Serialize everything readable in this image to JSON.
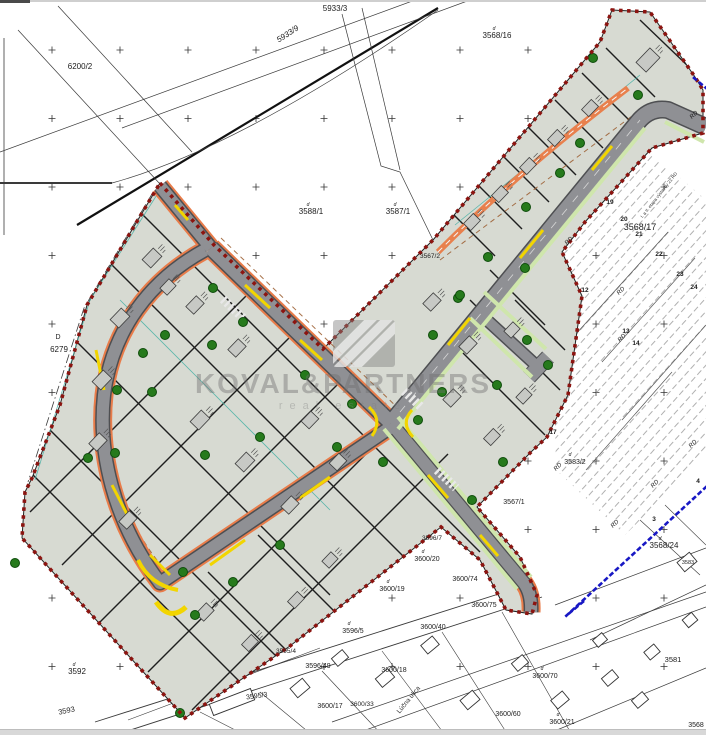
{
  "watermark": {
    "company": "KOVAL&PARTNERS",
    "tagline": "real estate"
  },
  "map": {
    "colors": {
      "dev_fill": "#d7dad2",
      "road": "#8f9094",
      "road_edge": "#e87c4a",
      "verge": "#cfe6ac",
      "tree": "#267a1c",
      "red_boundary": "#8c1410",
      "blue_boundary": "#1818c4",
      "yellow": "#f2d500"
    },
    "parcel_labels": [
      {
        "text": "5933/3",
        "x": 335,
        "y": 11,
        "size": 8
      },
      {
        "text": "5933/9",
        "x": 289,
        "y": 36,
        "rot": -33,
        "size": 8,
        "cls": "it"
      },
      {
        "text": "6200/2",
        "x": 80,
        "y": 69,
        "size": 8
      },
      {
        "text": "3568/16",
        "x": 497,
        "y": 38,
        "size": 8
      },
      {
        "text": "3588/1",
        "x": 311,
        "y": 214,
        "size": 8
      },
      {
        "text": "3587/1",
        "x": 398,
        "y": 214,
        "size": 8
      },
      {
        "text": "D",
        "x": 58,
        "y": 339,
        "size": 7
      },
      {
        "text": "6279",
        "x": 59,
        "y": 352,
        "size": 8
      },
      {
        "text": "3568/17",
        "x": 640,
        "y": 230,
        "size": 9
      },
      {
        "text": "3567/2",
        "x": 430,
        "y": 258,
        "size": 6.5
      },
      {
        "text": "3567/1",
        "x": 514,
        "y": 504,
        "size": 7
      },
      {
        "text": "3583/2",
        "x": 575,
        "y": 464,
        "size": 7
      },
      {
        "text": "3568/24",
        "x": 664,
        "y": 548,
        "size": 8
      },
      {
        "text": "3583",
        "x": 688,
        "y": 564,
        "size": 5.5
      },
      {
        "text": "3581",
        "x": 673,
        "y": 662,
        "size": 7.5
      },
      {
        "text": "3592",
        "x": 77,
        "y": 674,
        "size": 8
      },
      {
        "text": "3593",
        "x": 67,
        "y": 713,
        "rot": -12,
        "size": 7.5
      },
      {
        "text": "3595/3",
        "x": 257,
        "y": 698,
        "rot": -8,
        "size": 7
      },
      {
        "text": "3595/4",
        "x": 286,
        "y": 653,
        "size": 6.5
      },
      {
        "text": "3596/5",
        "x": 353,
        "y": 633,
        "size": 7
      },
      {
        "text": "3596/49",
        "x": 318,
        "y": 668,
        "size": 7
      },
      {
        "text": "3596/7",
        "x": 432,
        "y": 540,
        "size": 6.5
      },
      {
        "text": "3600/20",
        "x": 427,
        "y": 561,
        "size": 7
      },
      {
        "text": "3600/74",
        "x": 465,
        "y": 581,
        "size": 7
      },
      {
        "text": "3600/75",
        "x": 484,
        "y": 607,
        "size": 7
      },
      {
        "text": "3600/19",
        "x": 392,
        "y": 591,
        "size": 7
      },
      {
        "text": "3600/40",
        "x": 433,
        "y": 629,
        "size": 7
      },
      {
        "text": "3600/18",
        "x": 394,
        "y": 672,
        "size": 7
      },
      {
        "text": "3600/17",
        "x": 330,
        "y": 708,
        "size": 7
      },
      {
        "text": "3600/33",
        "x": 362,
        "y": 706,
        "size": 6.5
      },
      {
        "text": "3600/21",
        "x": 562,
        "y": 724,
        "size": 7
      },
      {
        "text": "3600/70",
        "x": 545,
        "y": 678,
        "size": 7
      },
      {
        "text": "3600/60",
        "x": 508,
        "y": 716,
        "size": 7
      },
      {
        "text": "3568",
        "x": 696,
        "y": 727,
        "size": 7
      }
    ],
    "d_marks": [
      {
        "text": "d",
        "x": 308,
        "y": 206
      },
      {
        "text": "d",
        "x": 395,
        "y": 206
      },
      {
        "text": "d",
        "x": 74,
        "y": 666
      },
      {
        "text": "d",
        "x": 423,
        "y": 553
      },
      {
        "text": "d",
        "x": 388,
        "y": 583
      },
      {
        "text": "d",
        "x": 570,
        "y": 456
      },
      {
        "text": "d",
        "x": 660,
        "y": 540
      },
      {
        "text": "d",
        "x": 494,
        "y": 30
      },
      {
        "text": "d",
        "x": 349,
        "y": 625
      },
      {
        "text": "d",
        "x": 558,
        "y": 716
      },
      {
        "text": "d",
        "x": 542,
        "y": 670
      }
    ],
    "lot_numbers": [
      {
        "text": "19",
        "x": 610,
        "y": 204
      },
      {
        "text": "20",
        "x": 624,
        "y": 221
      },
      {
        "text": "21",
        "x": 639,
        "y": 236
      },
      {
        "text": "22",
        "x": 659,
        "y": 256
      },
      {
        "text": "23",
        "x": 680,
        "y": 276
      },
      {
        "text": "24",
        "x": 694,
        "y": 289
      },
      {
        "text": "12",
        "x": 585,
        "y": 292
      },
      {
        "text": "13",
        "x": 626,
        "y": 333
      },
      {
        "text": "14",
        "x": 636,
        "y": 345
      },
      {
        "text": "17",
        "x": 553,
        "y": 434
      },
      {
        "text": "3",
        "x": 654,
        "y": 521
      },
      {
        "text": "4",
        "x": 698,
        "y": 483
      }
    ],
    "zone_labels": [
      {
        "text": "RD",
        "x": 570,
        "y": 242
      },
      {
        "text": "RD",
        "x": 622,
        "y": 292
      },
      {
        "text": "RD",
        "x": 623,
        "y": 339
      },
      {
        "text": "RD",
        "x": 559,
        "y": 468
      },
      {
        "text": "RD",
        "x": 656,
        "y": 485
      },
      {
        "text": "RD",
        "x": 694,
        "y": 445
      },
      {
        "text": "RD",
        "x": 616,
        "y": 525
      },
      {
        "text": "RD",
        "x": 695,
        "y": 116
      }
    ],
    "street_labels": [
      {
        "text": "Lúčna ulica",
        "x": 410,
        "y": 701,
        "rot": -51,
        "size": 6.5,
        "cls": "gray"
      },
      {
        "text": "I. a II. etapa výstavby 22 RD",
        "x": 660,
        "y": 196,
        "rot": -52,
        "size": 4.5,
        "cls": "gray"
      }
    ],
    "trees": [
      [
        213,
        288
      ],
      [
        243,
        322
      ],
      [
        212,
        345
      ],
      [
        305,
        375
      ],
      [
        260,
        437
      ],
      [
        337,
        447
      ],
      [
        205,
        455
      ],
      [
        383,
        462
      ],
      [
        433,
        335
      ],
      [
        458,
        298
      ],
      [
        497,
        385
      ],
      [
        418,
        420
      ],
      [
        165,
        335
      ],
      [
        143,
        353
      ],
      [
        117,
        390
      ],
      [
        152,
        392
      ],
      [
        88,
        458
      ],
      [
        115,
        453
      ],
      [
        15,
        563
      ],
      [
        183,
        572
      ],
      [
        233,
        582
      ],
      [
        280,
        545
      ],
      [
        195,
        615
      ],
      [
        180,
        713
      ],
      [
        488,
        257
      ],
      [
        525,
        268
      ],
      [
        460,
        295
      ],
      [
        527,
        340
      ],
      [
        548,
        365
      ],
      [
        442,
        392
      ],
      [
        503,
        462
      ],
      [
        472,
        500
      ],
      [
        593,
        58
      ],
      [
        638,
        95
      ],
      [
        580,
        143
      ],
      [
        560,
        173
      ],
      [
        526,
        207
      ],
      [
        352,
        404
      ]
    ],
    "buildings": [
      [
        152,
        258,
        16,
        12,
        -46
      ],
      [
        120,
        318,
        16,
        12,
        -46
      ],
      [
        102,
        380,
        16,
        12,
        -46
      ],
      [
        98,
        442,
        15,
        11,
        -46
      ],
      [
        128,
        520,
        15,
        11,
        -46
      ],
      [
        195,
        305,
        15,
        11,
        -46
      ],
      [
        237,
        348,
        15,
        11,
        -46
      ],
      [
        200,
        420,
        16,
        12,
        -46
      ],
      [
        245,
        462,
        16,
        12,
        -46
      ],
      [
        290,
        505,
        15,
        11,
        -46
      ],
      [
        310,
        420,
        14,
        11,
        -46
      ],
      [
        338,
        462,
        14,
        11,
        -46
      ],
      [
        205,
        612,
        15,
        11,
        -46
      ],
      [
        250,
        643,
        14,
        10,
        -46
      ],
      [
        296,
        600,
        14,
        10,
        -46
      ],
      [
        330,
        560,
        13,
        10,
        -46
      ],
      [
        432,
        302,
        15,
        11,
        -46
      ],
      [
        468,
        345,
        15,
        11,
        -46
      ],
      [
        452,
        398,
        15,
        11,
        -46
      ],
      [
        492,
        437,
        14,
        10,
        -46
      ],
      [
        524,
        396,
        13,
        10,
        -46
      ],
      [
        512,
        330,
        13,
        10,
        -46
      ],
      [
        472,
        222,
        14,
        10,
        -46
      ],
      [
        500,
        194,
        14,
        10,
        -46
      ],
      [
        528,
        166,
        14,
        10,
        -46
      ],
      [
        556,
        138,
        14,
        10,
        -46
      ],
      [
        590,
        108,
        14,
        10,
        -46
      ],
      [
        648,
        60,
        20,
        14,
        -46
      ],
      [
        168,
        287,
        13,
        10,
        -46
      ]
    ],
    "houses": [
      [
        232,
        702,
        44,
        12,
        -21
      ],
      [
        300,
        688,
        16,
        12,
        -40
      ],
      [
        340,
        658,
        14,
        10,
        -40
      ],
      [
        385,
        678,
        16,
        11,
        -40
      ],
      [
        430,
        645,
        15,
        11,
        -40
      ],
      [
        470,
        700,
        16,
        12,
        -40
      ],
      [
        520,
        663,
        14,
        10,
        -40
      ],
      [
        560,
        700,
        15,
        11,
        -40
      ],
      [
        610,
        678,
        14,
        10,
        -40
      ],
      [
        652,
        652,
        13,
        10,
        -40
      ],
      [
        600,
        640,
        12,
        9,
        -40
      ],
      [
        687,
        562,
        16,
        12,
        -40
      ],
      [
        640,
        700,
        14,
        10,
        -40
      ],
      [
        690,
        620,
        12,
        10,
        -40
      ]
    ]
  }
}
